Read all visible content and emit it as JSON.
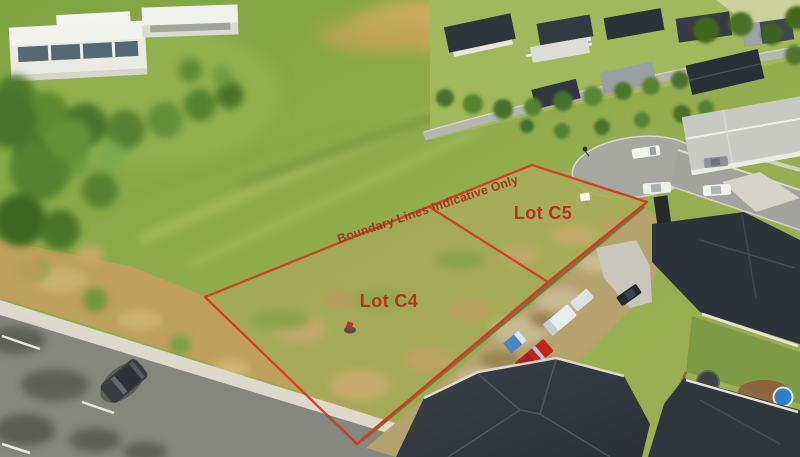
{
  "scene": {
    "type": "aerial-drone-photograph",
    "description": "Aerial view of two vacant grass residential sections outlined in red, beside a road, new dark-roofed houses, a cul-de-sac and farm paddocks",
    "disclaimer": "Boundary Lines Indicative Only",
    "lots": [
      {
        "id": "C4",
        "label": "Lot C4"
      },
      {
        "id": "C5",
        "label": "Lot C5"
      }
    ],
    "colors": {
      "boundary": "#d03c1e",
      "lot_label": "#b5331c",
      "disclaimer": "#a23722"
    }
  }
}
